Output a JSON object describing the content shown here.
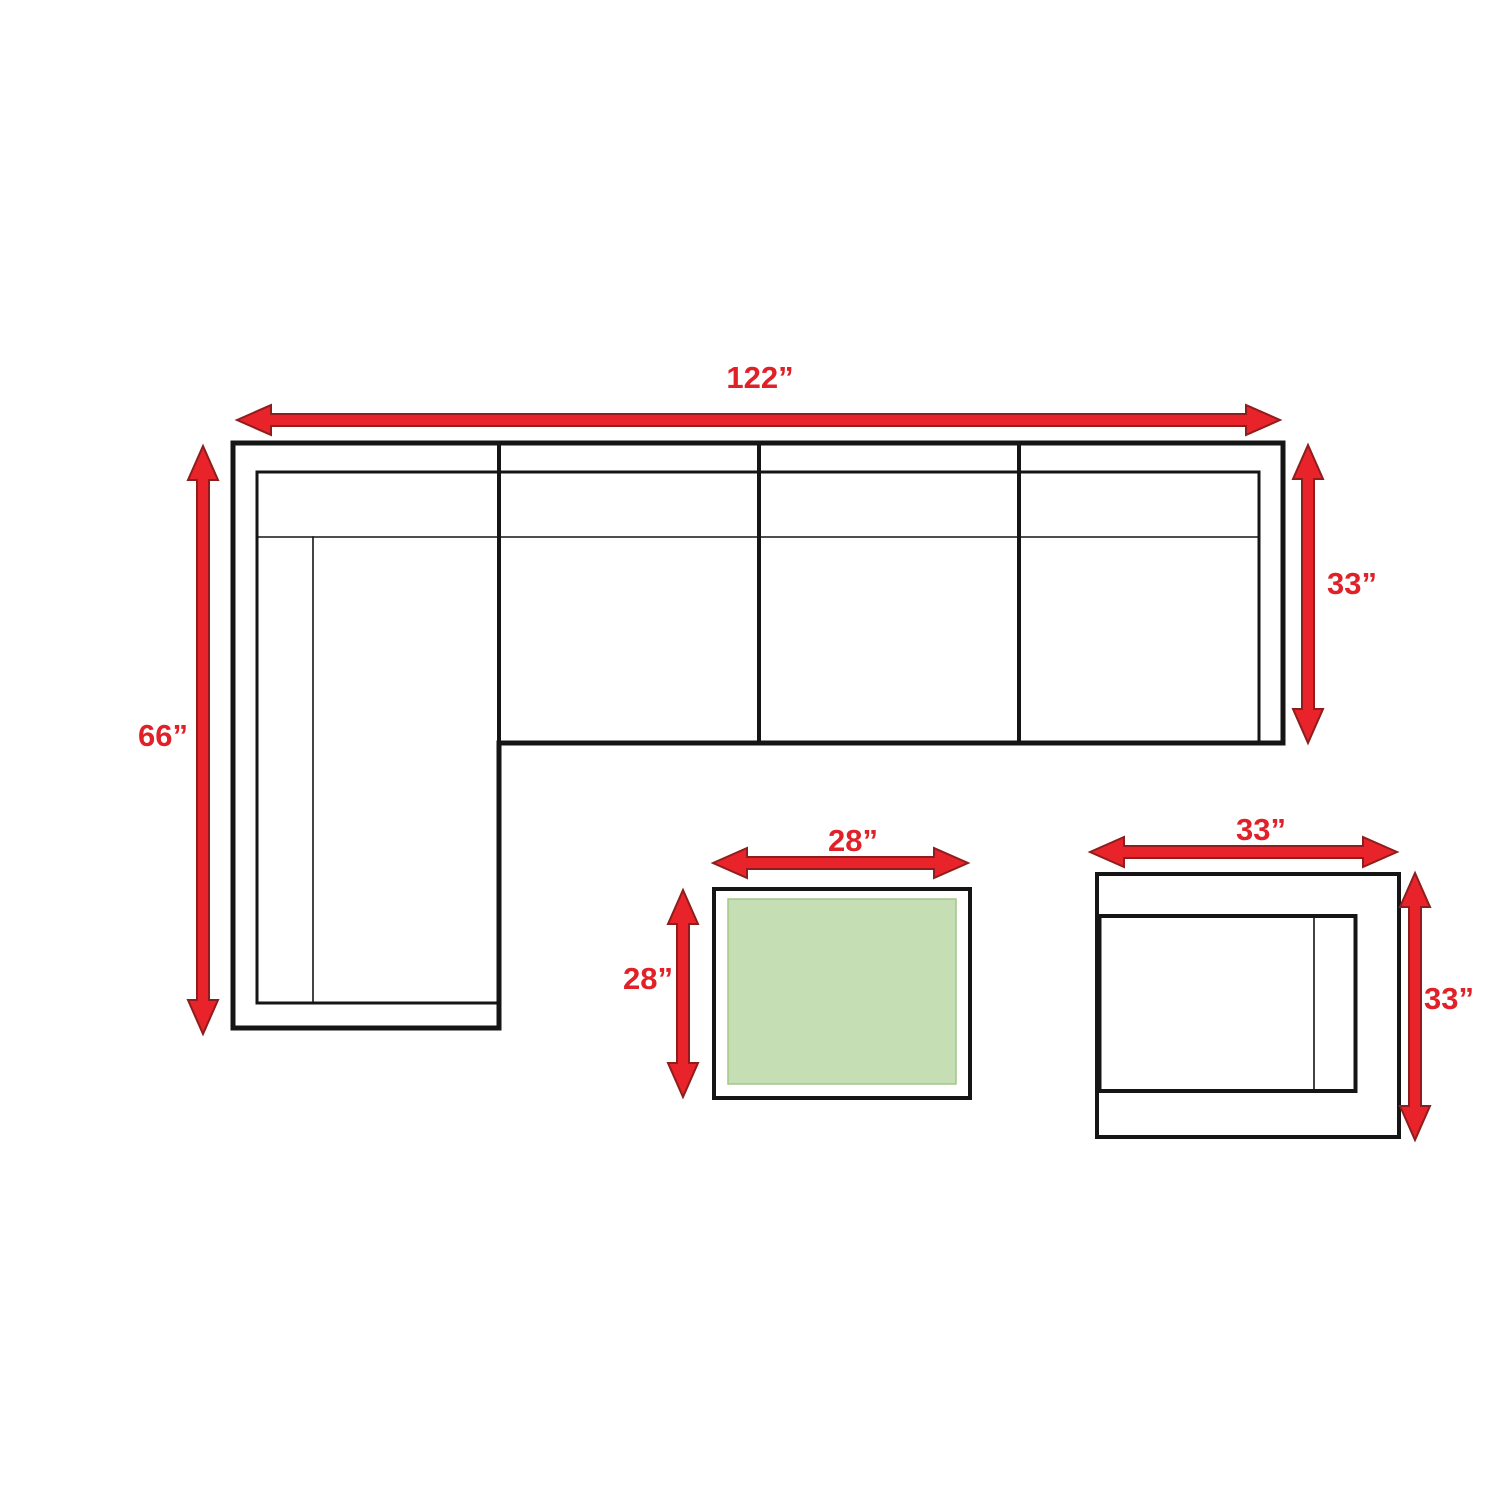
{
  "colors": {
    "page_bg": "#ffffff",
    "label_red": "#e02128",
    "arrow_red": "#e8232a",
    "arrow_outline": "#8f1d1d",
    "line_black": "#151515",
    "table_green": "#c6deb3",
    "table_green_border": "#a3c687"
  },
  "diagram": {
    "sectional": {
      "name": "sectional-sofa-top-view",
      "width_label": "122”",
      "height_label": "66”",
      "depth_label": "33”"
    },
    "coffee_table": {
      "name": "coffee-table-top-view",
      "width_label": "28”",
      "depth_label": "28”"
    },
    "side_table": {
      "name": "side-table-top-view",
      "width_label": "33”",
      "depth_label": "33”"
    }
  }
}
